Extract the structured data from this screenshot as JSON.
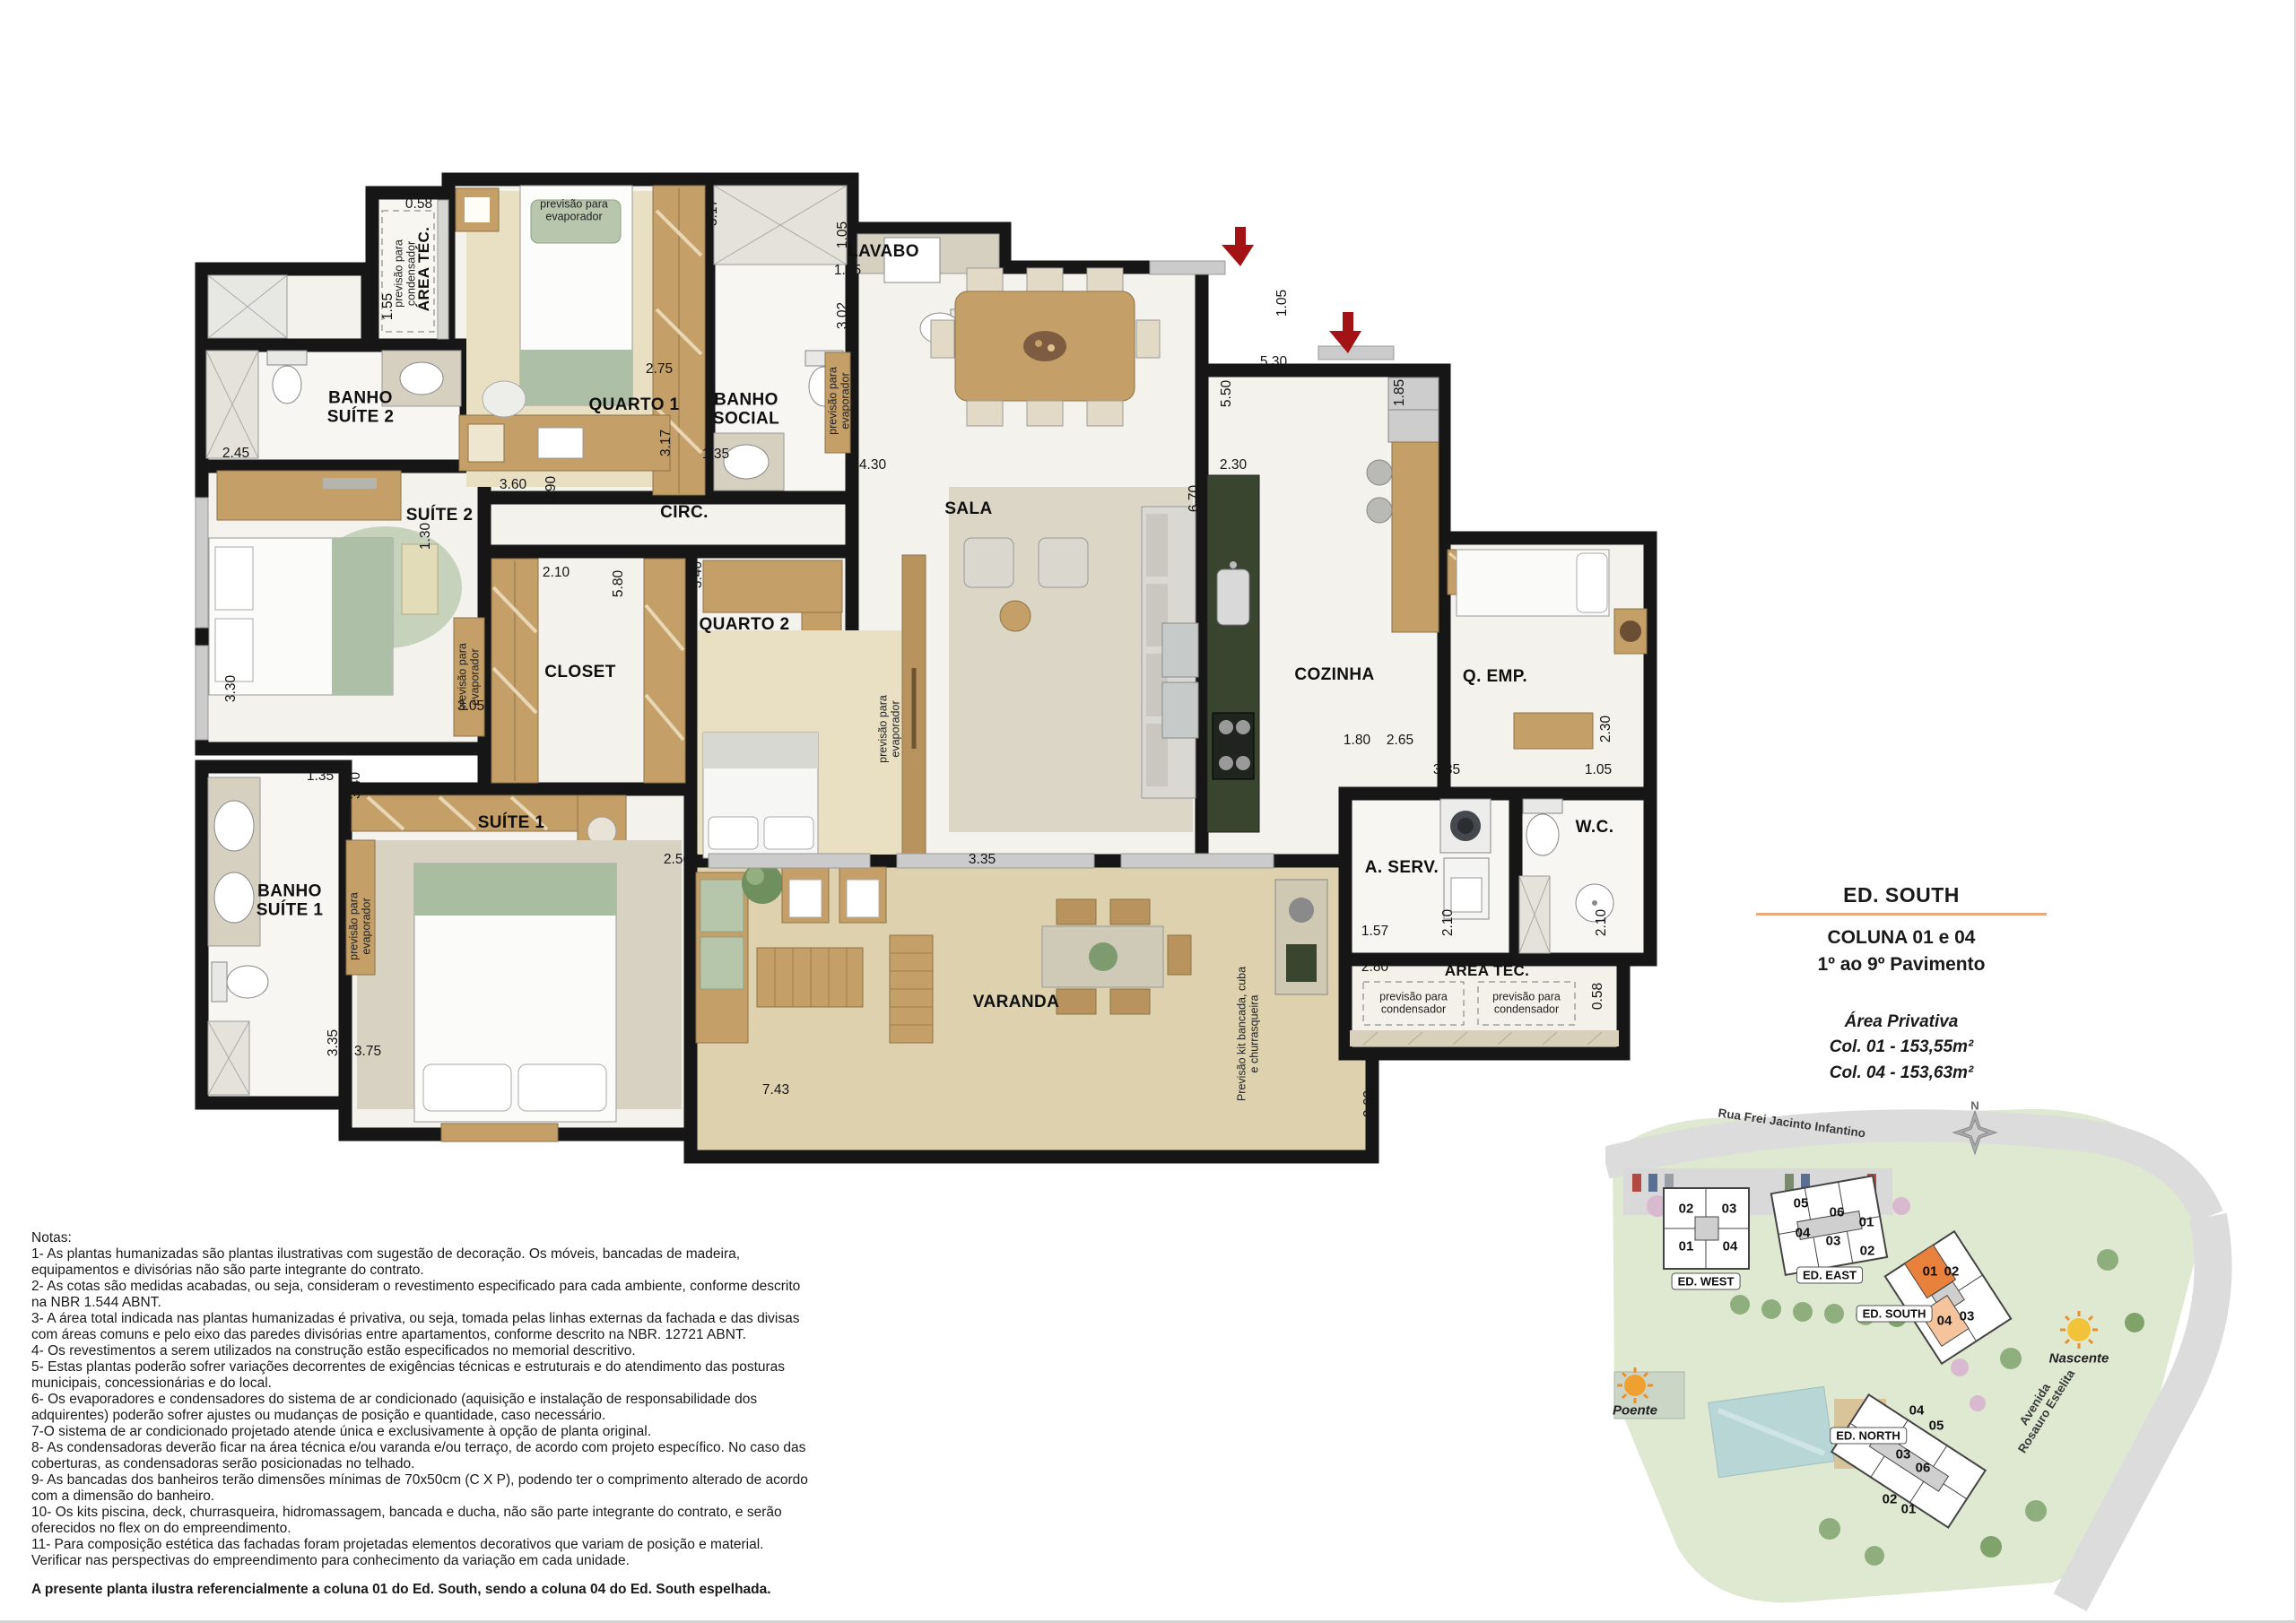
{
  "title_block": {
    "building": "ED. SOUTH",
    "line1": "COLUNA 01 e 04",
    "line2": "1º ao 9º Pavimento",
    "area_title": "Área Privativa",
    "area_col01": "Col. 01 - 153,55m²",
    "area_col04": "Col. 04 - 153,63m²",
    "accent_color": "#e9a97c"
  },
  "plan": {
    "rooms": {
      "area_tec_tl": "ÁREA TÉC.",
      "quarto1": "QUARTO 1",
      "banho_social": "BANHO\nSOCIAL",
      "lavabo": "LAVABO",
      "banho_suite2": "BANHO\nSUÍTE 2",
      "suite2": "SUÍTE 2",
      "circ": "CIRC.",
      "closet": "CLOSET",
      "quarto2": "QUARTO 2",
      "sala": "SALA",
      "cozinha": "COZINHA",
      "q_emp": "Q. EMP.",
      "wc": "W.C.",
      "a_serv": "A. SERV.",
      "area_tec_br": "ÁREA TÉC.",
      "varanda": "VARANDA",
      "suite1": "SUÍTE 1",
      "banho_suite1": "BANHO\nSUÍTE 1"
    },
    "annotations": {
      "evaporador": "previsão para\nevaporador",
      "condensador": "previsão para\ncondensador",
      "kit_varanda": "Previsão kit bancada, cuba\ne churrasqueira"
    },
    "dims": {
      "d058": "0.58",
      "d090": "0.90",
      "d105": "1.05",
      "d130": "1.30",
      "d135": "1.35",
      "d155": "1.55",
      "d157": "1.57",
      "d180": "1.80",
      "d185": "1.85",
      "d210": "2.10",
      "d230": "2.30",
      "d245": "2.45",
      "d250": "2.50",
      "d263": "2.63",
      "d265": "2.65",
      "d275": "2.75",
      "d280": "2.80",
      "d302": "3.02",
      "d305": "3.05",
      "d317": "3.17",
      "d330": "3.30",
      "d335": "3.35",
      "d340": "3.40",
      "d360": "3.60",
      "d375": "3.75",
      "d430": "4.30",
      "d530": "5.30",
      "d550": "5.50",
      "d580": "5.80",
      "d670": "6.70",
      "d743": "7.43"
    }
  },
  "site_map": {
    "streets": {
      "top": "Rua Frei Jacinto Infantino",
      "right_line1": "Avenida",
      "right_line2": "Rosauro Estelita"
    },
    "compass_n": "N",
    "sun_west": "Poente",
    "sun_east": "Nascente",
    "buildings": {
      "west": {
        "name": "ED. WEST",
        "units": [
          "02",
          "03",
          "01",
          "04"
        ]
      },
      "east": {
        "name": "ED. EAST",
        "units": [
          "05",
          "06",
          "01",
          "04",
          "03",
          "02"
        ]
      },
      "south": {
        "name": "ED. SOUTH",
        "units": [
          "01",
          "02",
          "04",
          "03"
        ],
        "unit01_color": "#e8813c",
        "unit04_color": "#f6c49c"
      },
      "north": {
        "name": "ED. NORTH",
        "units": [
          "04",
          "05",
          "03",
          "06",
          "02",
          "01"
        ]
      }
    }
  },
  "notes": {
    "title": "Notas:",
    "body": "1- As plantas humanizadas são plantas ilustrativas com sugestão de decoração. Os móveis, bancadas de madeira,\nequipamentos e divisórias não são parte integrante do contrato.\n2- As cotas são medidas acabadas, ou seja, consideram o revestimento especificado para cada ambiente, conforme descrito\nna NBR 1.544 ABNT.\n3- A área total indicada nas plantas humanizadas é privativa, ou seja, tomada pelas linhas externas da fachada e das divisas\ncom áreas comuns e pelo eixo das paredes divisórias entre apartamentos, conforme descrito na NBR. 12721 ABNT.\n4- Os revestimentos a serem utilizados na construção estão especificados no memorial descritivo.\n5- Estas plantas poderão sofrer variações decorrentes de exigências técnicas e estruturais e do atendimento das posturas\nmunicipais, concessionárias e do local.\n6- Os evaporadores e condensadores do sistema de ar condicionado (aquisição e instalação de responsabilidade dos\nadquirentes) poderão sofrer ajustes ou mudanças de posição e quantidade, caso necessário.\n7-O sistema de ar condicionado projetado atende única e exclusivamente à opção de planta original.\n8- As condensadoras deverão ficar na área técnica e/ou varanda e/ou terraço, de acordo com projeto específico. No caso das\ncoberturas, as condensadoras serão posicionadas no telhado.\n9- As bancadas dos banheiros terão dimensões mínimas de 70x50cm (C X P), podendo ter o comprimento alterado de acordo\ncom a dimensão do banheiro.\n10- Os kits piscina, deck, churrasqueira, hidromassagem, bancada e ducha, não são parte integrante do contrato, e serão\noferecidos no flex on do empreendimento.\n11- Para composição estética das fachadas foram projetadas elementos decorativos que variam de posição e material.\nVerificar nas perspectivas do empreendimento para conhecimento da variação em cada unidade.",
    "footer": "A presente planta ilustra referencialmente a coluna 01 do Ed. South, sendo a coluna 04 do Ed. South espelhada."
  }
}
